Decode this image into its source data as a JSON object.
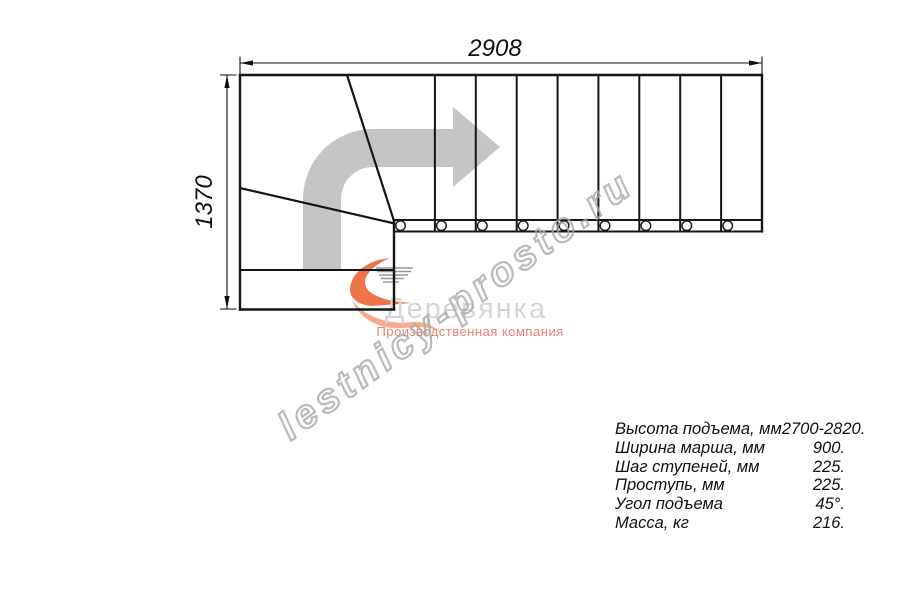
{
  "dimensions": {
    "width_label": "2908",
    "height_label": "1370"
  },
  "watermark": {
    "text": "lestnicy-prosto.ru"
  },
  "logo": {
    "name": "Деревянка",
    "subtitle": "Производственная компания"
  },
  "specs": {
    "rows": [
      {
        "label": "Высота подъема, мм",
        "value": "2700-2820."
      },
      {
        "label": "Ширина марша, мм",
        "value": "900."
      },
      {
        "label": "Шаг ступеней, мм",
        "value": "225."
      },
      {
        "label": "Проступь, мм",
        "value": "225."
      },
      {
        "label": "Угол подъема",
        "value": "45°."
      },
      {
        "label": "Масса, кг",
        "value": "216."
      }
    ]
  },
  "colors": {
    "line": "#161616",
    "dimension_line": "#111111",
    "direction_arrow": "#c5c5c5",
    "flame": "#f0744a",
    "flame_light": "#f8ab8a",
    "speed_lines": "#999999",
    "logo_name": "#d6d6d6",
    "logo_subtitle": "#ee8270",
    "watermark_outline": "#a9a9a9"
  }
}
